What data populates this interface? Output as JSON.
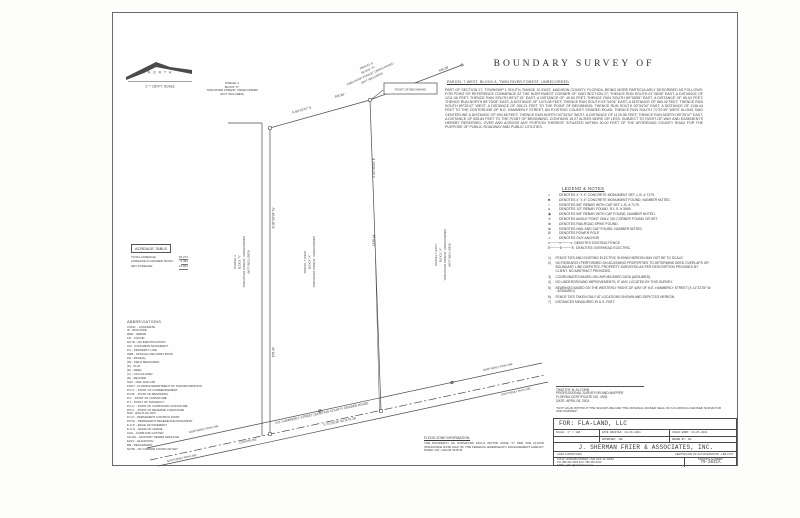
{
  "colors": {
    "ink": "#3d3d3d",
    "line": "#4a4a4a",
    "paper": "#fefefe"
  },
  "north": {
    "label": "N O R T H",
    "scale": "1\" = 100 FT. SCALE"
  },
  "header": {
    "title": "BOUNDARY SURVEY OF",
    "subtitle": "PARCEL 7 WEST, BLOCK A, TWIN RIVER FOREST, UNRECORDED",
    "description": "PART OF SECTION 27, TOWNSHIP 1 SOUTH, RANGE 10 EAST, MADISON COUNTY, FLORIDA, BEING MORE PARTICULARLY DESCRIBED AS FOLLOWS:  FOR POINT OF REFERENCE COMMENCE AT THE NORTHWEST CORNER OF SAID SECTION 27; THENCE RUN SOUTH 01°38'08\" EAST, A DISTANCE OF 1211.08 FEET; THENCE RUN SOUTH 89°47'15\" EAST, A DISTANCE OF 49.50 FEET; THENCE RUN SOUTH 89°38'55\" EAST, A DISTANCE OF 85.04 FEET; THENCE RUN NORTH 89°23'08\" EAST, A DISTANCE OF 1473.08 FEET; THENCE RUN SOUTH 03°34'04\" EAST, A DISTANCE OF 680.42 FEET; THENCE RUN SOUTH 89°25'47\" WEST, A DISTANCE OF 265.21 FEET TO THE POINT OF BEGINNING; THENCE RUN SOUTH 00°34'04\" EAST, A DISTANCE OF 1138.44 FEET TO THE CENTERLINE OF N.E. HAMMERLY STREET, AN EXISTING COUNTY GRADED ROAD; THENCE RUN SOUTH 71°20'39\" WEST ALONG SAID CENTERLINE A DISTANCE OF 594.58 FEET; THENCE RUN NORTH 00°34'04\" WEST, A DISTANCE OF 1176.36 FEET; THENCE RUN NORTH 89°25'47\" EAST, A DISTANCE OF 635.84 FEET TO THE POINT OF BEGINNING. CONTAINS 15.27 ACRES MORE OR LESS. SUBJECT TO RIGHT-OF-WAY AND EASEMENTS HEREBY RESERVED, OVER AND ACROSS ANY PORTION THEREOF SITUATED WITHIN 30.00 FEET OF THE AFORESAID COUNTY ROAD FOR THE PURPOSE OF PUBLIC ROADWAY AND PUBLIC UTILITIES."
  },
  "legend": {
    "heading": "LEGEND & NOTES",
    "items": [
      {
        "sym": "□",
        "text": "DENOTES 4\" X 4\" CONCRETE MONUMENT SET, L.B. # 7179."
      },
      {
        "sym": "■",
        "text": "DENOTES 4\" X 4\" CONCRETE MONUMENT FOUND, NUMBER NOTED."
      },
      {
        "sym": "○",
        "text": "DENOTES 5/8\" REBAR WITH CAP SET, L.B. # 7179."
      },
      {
        "sym": "●",
        "text": "DENOTES 1/2\" REBAR FOUND, R.L.S. # 3949."
      },
      {
        "sym": "◉",
        "text": "DENOTES 5/8\" REBAR WITH CAP FOUND, NUMBER NOTED."
      },
      {
        "sym": "✕",
        "text": "DENOTES ANGLE POINT ONLY, NO CORNER FOUND OR SET."
      },
      {
        "sym": "⊕",
        "text": "DENOTES RAILROAD SPIKE FOUND."
      },
      {
        "sym": "⊗",
        "text": "DENOTES NAIL AND CAP FOUND, NUMBER NOTED."
      },
      {
        "sym": "Ø",
        "text": "DENOTES POWER POLE"
      },
      {
        "sym": "⊥",
        "text": "DENOTES GUY ANCHOR"
      },
      {
        "sym": "x────x────x",
        "text": "DENOTES EXISTING FENCE."
      },
      {
        "sym": "E────E────E",
        "text": "DENOTES OVERHEAD ELECTRIC."
      }
    ]
  },
  "notes": {
    "items": [
      {
        "n": "1)",
        "text": "FENCE TIES AND EXISTING ELECTRIC SHOWN HEREON MAY NOT BE TO SCALE."
      },
      {
        "n": "2)",
        "text": "NO RESEARCH PERFORMED ON ADJOINING PROPERTIES TO DETERMINE DEED OVERLAPS OR BOUNDARY LINE DISPUTES. PROPERTY SURVEYED AS PER DESCRIPTION PROVIDED BY CLIENT. NO ABSTRACT PROVIDED."
      },
      {
        "n": "3)",
        "text": "COORDINATES BASED ON UNPUBLISHED DATA (ASSUMED)."
      },
      {
        "n": "4)",
        "text": "NO UNDERGROUND IMPROVEMENTS, IF ANY, LOCATED BY THIS SURVEY."
      },
      {
        "n": "5)",
        "text": "BEARINGS BASED ON THE WESTERLY RIGHT-OF-WAY OF N.E. HAMMERLY STREET (S 11°22'25\" W - ASSUMED)."
      },
      {
        "n": "6)",
        "text": "FENCE TIES TAKEN ONLY AT LOCATIONS SHOWN AND DEPICTED HEREON."
      },
      {
        "n": "7)",
        "text": "DISTANCES MEASURED IN U.S. FEET."
      }
    ]
  },
  "acreage": {
    "heading": "ACREAGE TABLE",
    "rows": [
      {
        "label": "TOTAL ACREAGE:",
        "value": "15.27±"
      },
      {
        "label": "ACREAGE IN GRADED ROAD:",
        "value": "0.45±"
      },
      {
        "label": "NET ACREAGE:",
        "value": "14.82±"
      }
    ]
  },
  "abbr": {
    "heading": "ABBREVIATIONS",
    "items": [
      "CONC. - CONCRETE",
      "IP - IRON PIPE",
      "REB. - REBAR",
      "FD. - FOUND",
      "NO ID - NO IDENTIFICATION",
      "CM - CONCRETE MONUMENT",
      "P/L - PROPERTY LINE",
      "ORB - OFFICIAL RECORDS BOOK",
      "PG - PAGE(S)",
      "(M) - FIELD MEASURED",
      "(P) - PLAT",
      "(D) - DEED",
      "(C) - CALCULATED",
      "(R) - RECORD",
      "N&C - NAIL AND CAP",
      "FDOT - FLORIDA DEPARTMENT OF TRANSPORTATION",
      "P.O.C. - POINT OF COMMENCEMENT",
      "P.O.B. - POINT OF BEGINNING",
      "P.C. - POINT OF CURVATURE",
      "P.T. - POINT OF TANGENCY",
      "P.C.C. - POINT OF COMPOUND CURVATURE",
      "P.R.C. - POINT OF REVERSE CURVATURE",
      "R/W - RIGHT-OF-WAY",
      "P.C.P. - PERMANENT CONTROL POINT",
      "P.R.M. - PERMANENT REFERENCE MONUMENT",
      "E.O.P. - EDGE OF PAVEMENT",
      "E.O.G. - EDGE OF GRADE",
      "C&G - CURB AND GUTTER",
      "SS MH - SANITARY SEWER MANHOLE",
      "ELEV. - ELEVATION",
      "BM - BENCHMARK",
      "NOTE - NO CORNER FOUND OR SET"
    ]
  },
  "flood": {
    "heading": "FLOOD ZONE INFORMATION:",
    "text": "THE PROPERTY AS SURVEYED FALLS WITHIN ZONE \"X\" PER THE FLOOD INSURANCE RATE MAP OF THE FEDERAL EMERGENCY MANAGEMENT AGENCY PANEL NO. 120145 0100 B."
  },
  "cert": {
    "name": "TIMOTHY B. ALCORN",
    "role": "PROFESSIONAL SURVEYOR AND MAPPER",
    "number": "FLORIDA CERTIFICATE NO. 4932",
    "date": "DATE: APRIL 05, 2001",
    "disclaimer": "\"NOT VALID WITHOUT THE SIGNATURE AND THE ORIGINAL RAISED SEAL OF A FLORIDA LICENSED SURVEYOR AND MAPPER\""
  },
  "titleblock": {
    "client": "FOR: FLA-LAND, LLC",
    "scale": "SCALE: 1\" = 100'",
    "drafted": "DATE DRAFTED: 04-06-2001",
    "fieldwork": "FIELD WORK: 04-05-2001",
    "approved": "APPROVED: JSF",
    "drawn": "DRAWN BY: RA",
    "company": "J. SHERMAN FRIER & ASSOCIATES, INC.",
    "trade": "LAND SURVEYORS",
    "authorization": "CERTIFICATE OF AUTHORIZATION - LB# 7179",
    "address": "106 W. HOWARD STREET, LIVE OAK, FL 32064",
    "phone": "PH: 386-362-4629   FAX: 386-362-4013",
    "email": "EMAIL: jsfrier@windstream.net",
    "drawing_label": "DRAWING NUMBER:",
    "drawing_number": "79-2031A"
  },
  "drawing": {
    "pob": "POINT OF BEGINNING",
    "bearing_top": "N 89°25'47\" E",
    "dist_top": "635.84'",
    "dist_ne": "435.38'",
    "bearing_right": "S 00°34'04\" E",
    "dist_right": "1138.44'",
    "bearing_left": "N 00°34'04\" W",
    "dist_left": "678.44'",
    "street": "N.E. HAMMERLY STREET  (EXISTING COUNTY GRADED ROAD)",
    "street_bearing": "S 71°20'39\" W   1176.36'",
    "rw_north": "NORTHERLY R/W LINE",
    "rw_south": "SOUTHERLY R/W LINE",
    "centerline_label": "CENTERLINE",
    "p2": [
      "PARCEL 2",
      "BLOCK \"K\"",
      "TWIN RIVER FOREST, UNRECORDED",
      "(NOT INCLUDED)"
    ],
    "p3": [
      "PARCEL 3",
      "BLOCK \"K\"",
      "TWIN RIVER FOREST, UNRECORDED",
      "(NOT INCLUDED)"
    ],
    "p7w": [
      "PARCEL 7 WEST",
      "BLOCK \"A\"",
      "TWIN RIVER FOREST, UNRECORDED"
    ],
    "p7e": [
      "PARCEL 7 EAST",
      "BLOCK \"A\"",
      "TWIN RIVER FOREST, UNRECORDED",
      "(NOT INCLUDED)"
    ],
    "p8": [
      "PARCEL 8",
      "BLOCK \"A\"",
      "TWIN RIVER FOREST, UNRECORDED",
      "(NOT INCLUDED)"
    ]
  }
}
